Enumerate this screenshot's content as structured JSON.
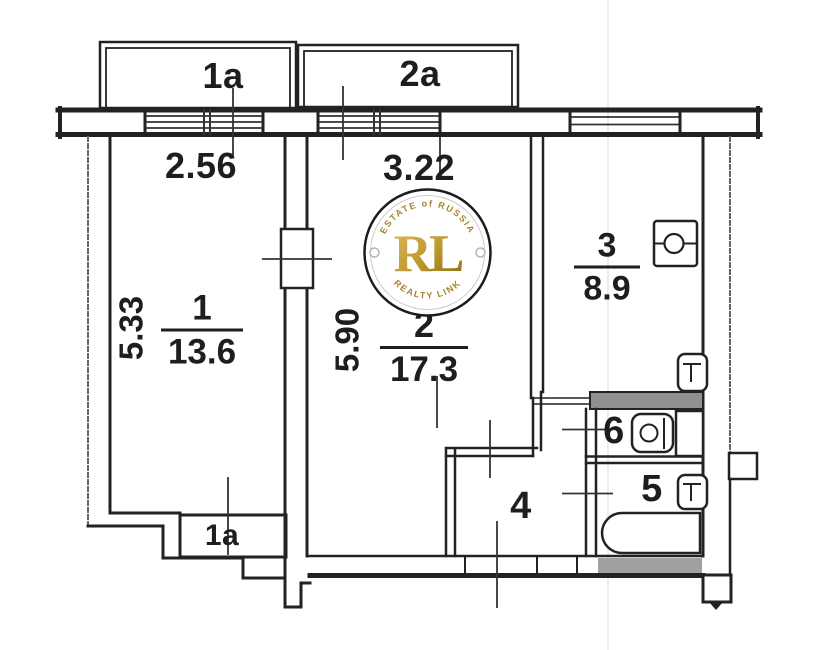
{
  "plan": {
    "balconies": [
      {
        "label": "1a"
      },
      {
        "label": "2a"
      }
    ],
    "dimensions": {
      "room1_window_width": "2.56",
      "room2_window_width": "3.22",
      "room1_depth": "5.33",
      "room2_depth": "5.90"
    },
    "rooms": [
      {
        "number": "1",
        "area": "13.6"
      },
      {
        "number": "2",
        "area": "17.3"
      },
      {
        "number": "3",
        "area": "8.9"
      },
      {
        "number": "4",
        "area": null
      },
      {
        "number": "5",
        "area": null
      },
      {
        "number": "6",
        "area": null
      }
    ],
    "balcony_door_label": "1a",
    "fixtures": [
      "stove-icon",
      "kitchen-door-icon",
      "toilet-icon",
      "washbasin-icon",
      "bath-door-icon",
      "bathtub-icon"
    ],
    "line_color": "#222222"
  },
  "watermark": {
    "initials": "RL",
    "arc_top": "ESTATE of RUSSIA",
    "arc_bottom": "REALTY LINK",
    "gold_color": "#b68d2d"
  }
}
